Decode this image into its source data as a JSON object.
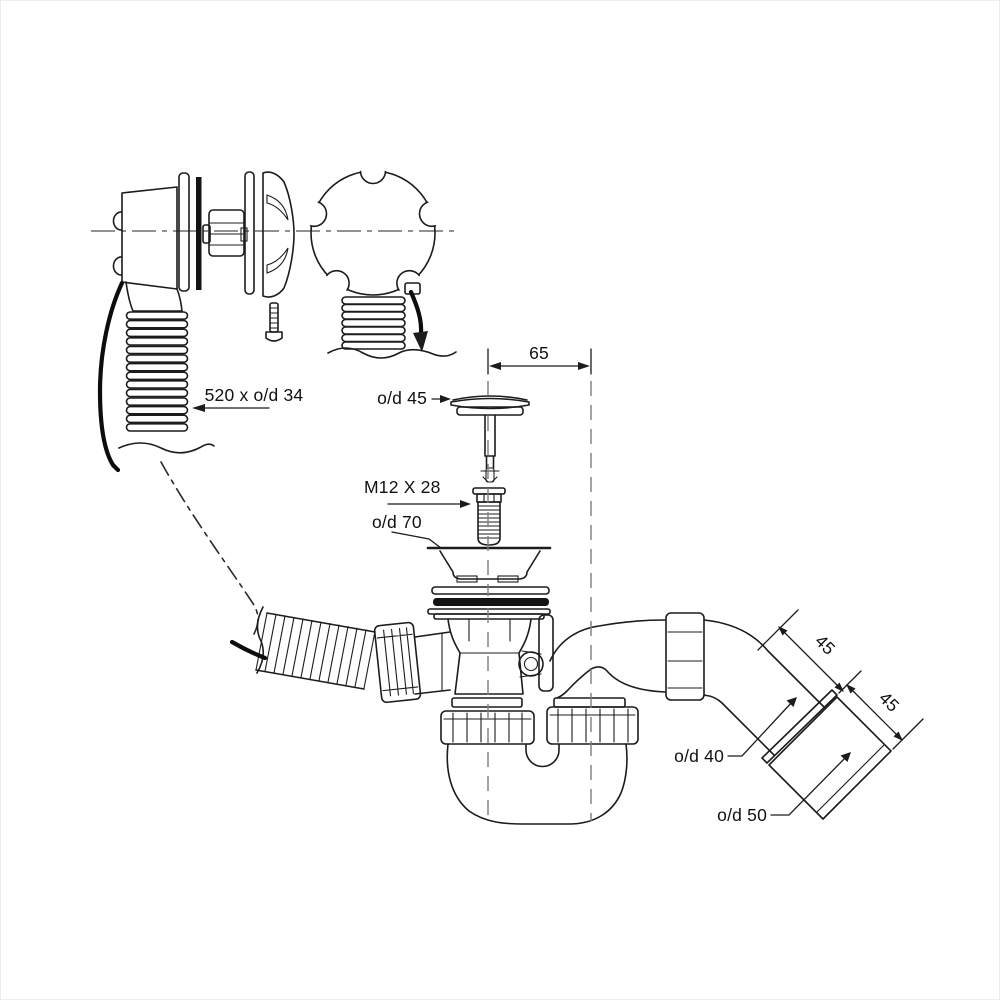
{
  "page": {
    "background": "#ffffff",
    "border_color": "#ececec"
  },
  "diagram": {
    "line_color": "#1c1c1c",
    "centerline_color": "#7e7e7e",
    "labels": {
      "overflow_hose": "520 x o/d 34",
      "plug_diameter": "o/d 45",
      "centre_distance": "65",
      "bolt_size": "M12 X 28",
      "flange_diameter": "o/d 70",
      "outlet_length_upper": "45",
      "outlet_length_lower": "45",
      "outlet_pipe_diameter": "o/d 40",
      "outlet_end_diameter": "o/d 50"
    }
  }
}
